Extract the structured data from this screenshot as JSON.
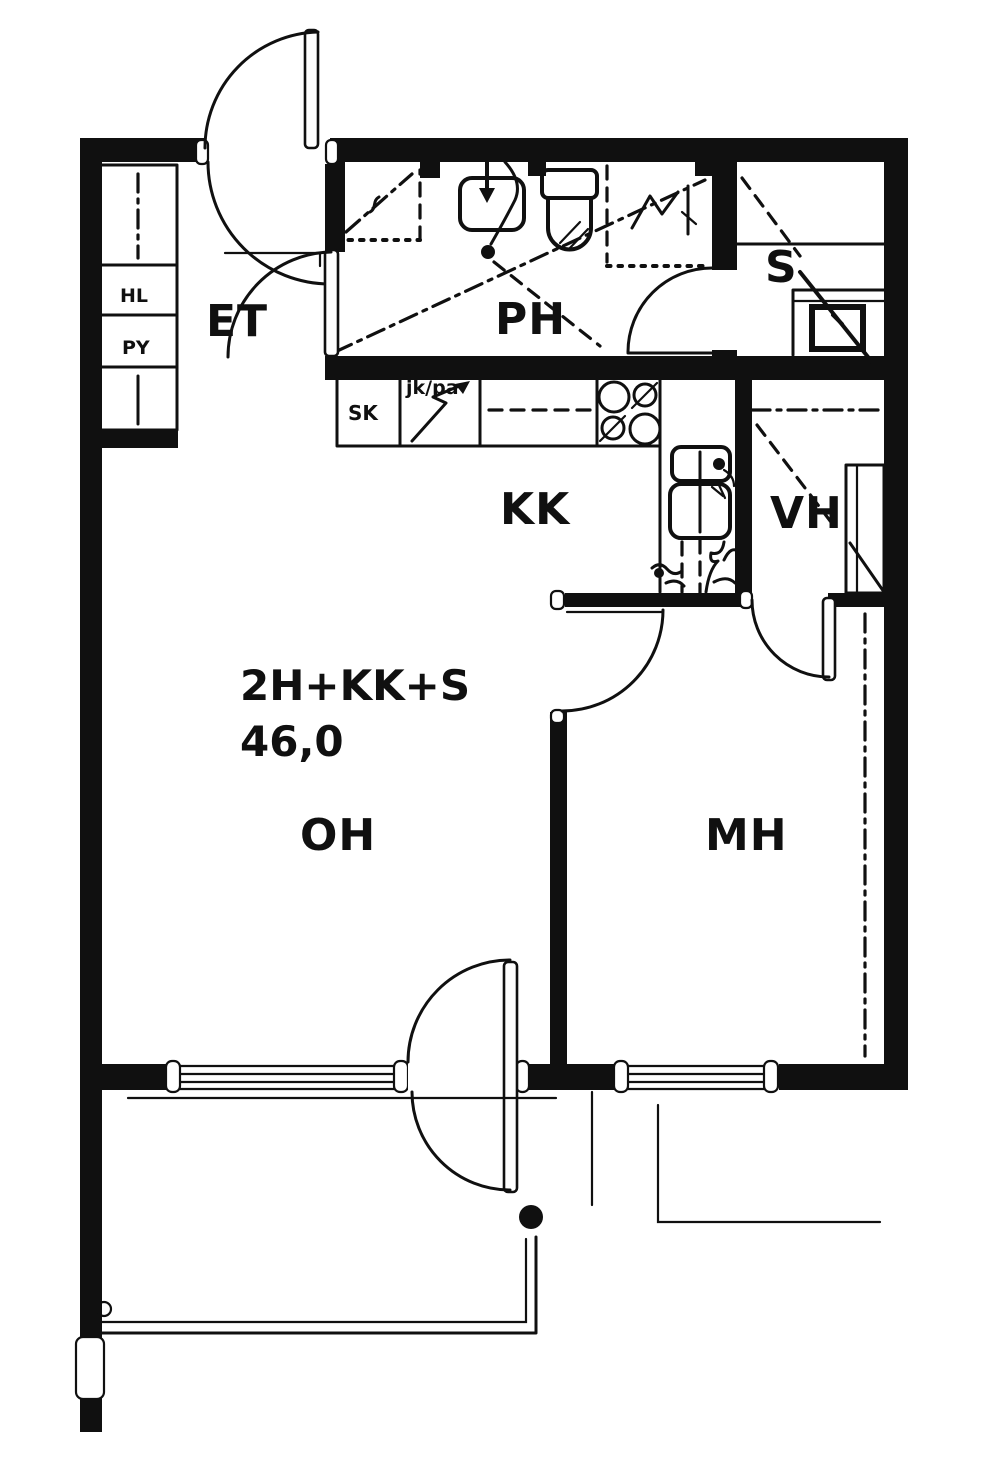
{
  "plan": {
    "type_label": "2H+KK+S",
    "area_label": "46,0",
    "rooms": {
      "entrance_hall": "ET",
      "bathroom": "PH",
      "sauna": "S",
      "kitchenette": "KK",
      "walkin_closet": "VH",
      "living_room": "OH",
      "bedroom": "MH"
    },
    "fixtures": {
      "closet_top": "HL",
      "closet_bottom": "PY",
      "cleaning_cupboard": "SK",
      "fridge_freezer": "jk/pa"
    },
    "colors": {
      "ink": "#101010",
      "paper": "#ffffff"
    }
  }
}
